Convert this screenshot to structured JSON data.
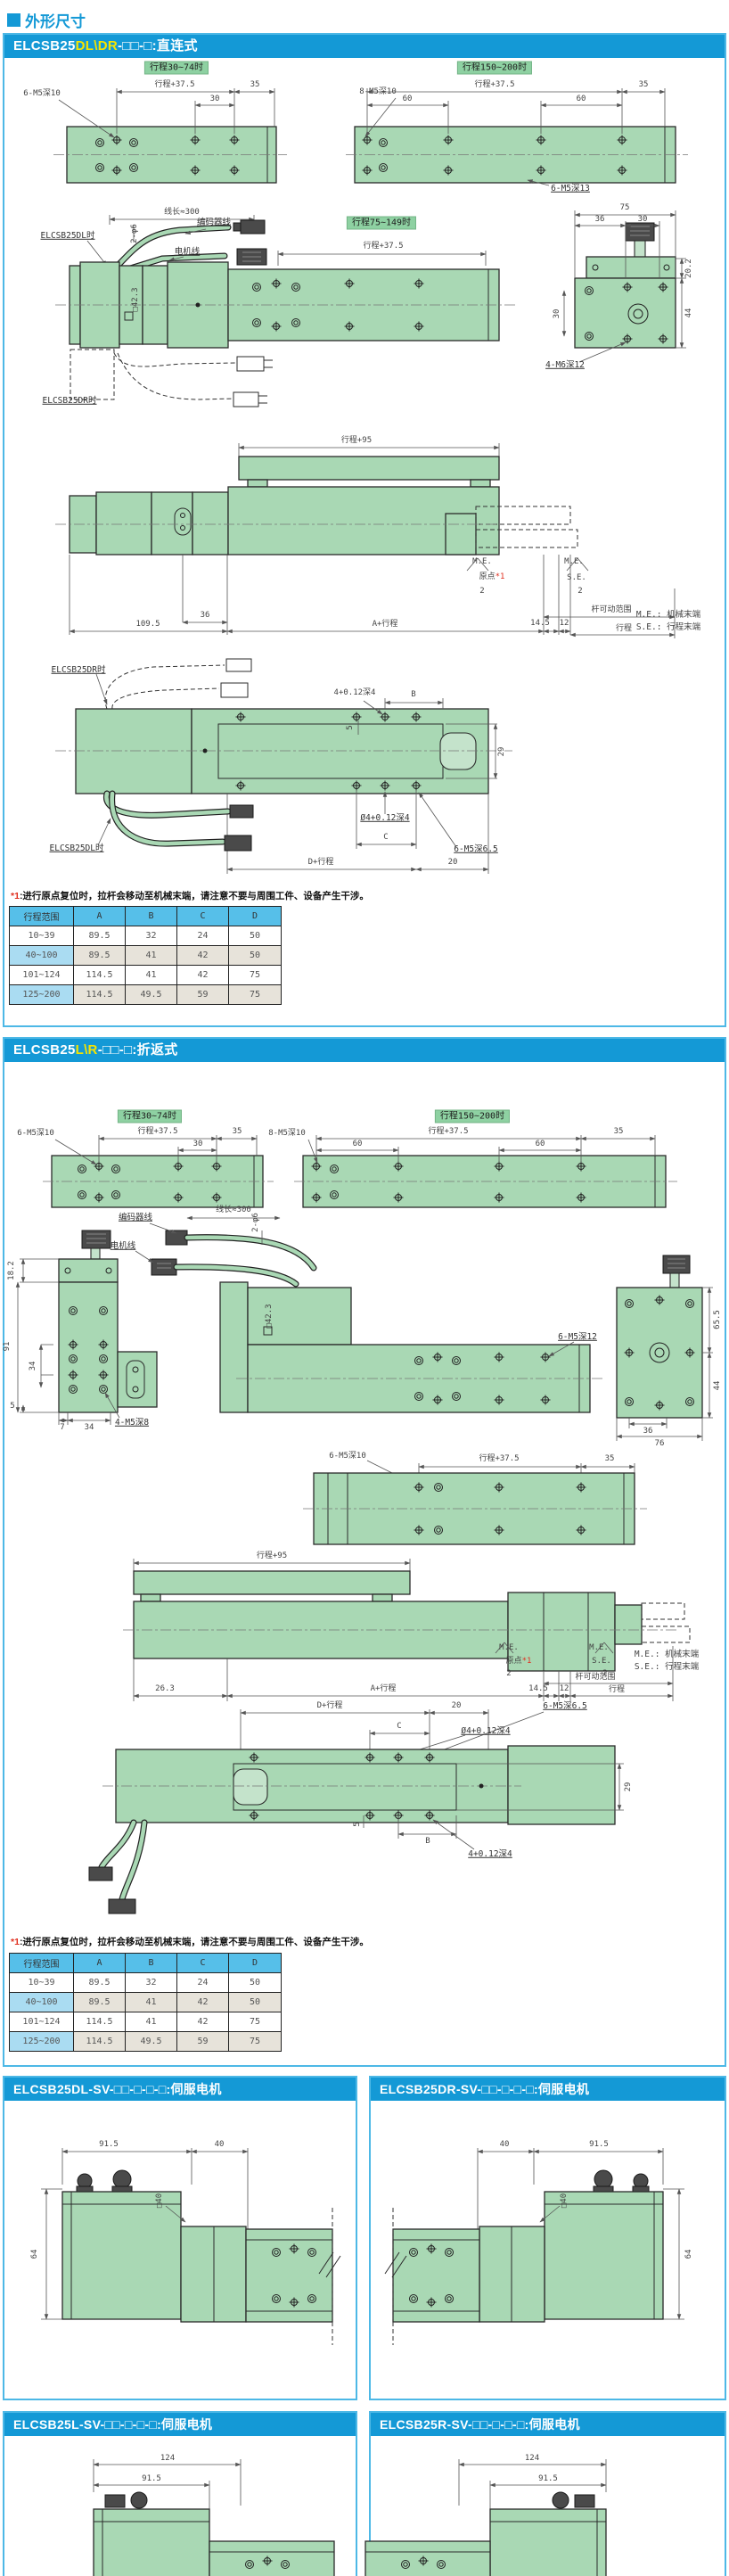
{
  "page": {
    "title": "外形尺寸"
  },
  "colors": {
    "blue": "#1499d6",
    "yellow": "#f6e400",
    "green_body": "#a9d8b4",
    "tag_green": "#8ed1a2",
    "table_header": "#56bfe9",
    "row_blue": "#aadcf2",
    "row_tan": "#e7e3da",
    "note_ref_red": "#e03020"
  },
  "panel_direct": {
    "header": {
      "prefix": "ELCSB25",
      "variant": "DL\\DR",
      "suffix": "-□□-□:直连式"
    },
    "top": {
      "tag_left": "行程30~74时",
      "tag_right": "行程150~200时",
      "stroke375_left": "行程+37.5",
      "d35_left": "35",
      "d30": "30",
      "leader_left": "6-M5深10",
      "stroke375_right": "行程+37.5",
      "d35_right": "35",
      "d60a": "60",
      "d60b": "60",
      "leader_right": "8-M5深10"
    },
    "cable": {
      "wire_len": "线长≈300",
      "phi6": "2-φ6",
      "encoder": "编码器线",
      "motor": "电机线",
      "dl": "ELCSB25DL时",
      "dr": "ELCSB25DR时"
    },
    "side": {
      "tag_mid": "行程75~149时",
      "stroke375": "行程+37.5",
      "sq423": "□42.3",
      "m5_13": "6-M5深13"
    },
    "end": {
      "d75": "75",
      "d36": "36",
      "d30": "30",
      "d20_2": "20.2",
      "d44": "44",
      "d30v": "30",
      "m6_12": "4-M6深12"
    },
    "stroke": {
      "s95": "行程+95",
      "me": "M.E.",
      "se": "S.E.",
      "origin": "原点",
      "ref": "*1",
      "d2": "2",
      "range": "杆可动范围",
      "stroke": "行程",
      "d109_5": "109.5",
      "d36": "36",
      "a_stroke": "A+行程",
      "d14_5": "14.5",
      "d12": "12",
      "legend_me": "M.E.: 机械末端",
      "legend_se": "S.E.: 行程末端"
    },
    "bottom": {
      "dr": "ELCSB25DR时",
      "dl": "ELCSB25DL时",
      "b": "B",
      "d4": "4+0.12深4",
      "d5": "5",
      "d29": "29",
      "phi4": "Ø4+0.12深4",
      "c": "C",
      "m5_65": "6-M5深6.5",
      "d_stroke": "D+行程",
      "d20": "20"
    },
    "note": {
      "ref": "*1",
      "text": ":进行原点复位时，拉杆会移动至机械末端，请注意不要与周围工件、设备产生干涉。"
    },
    "table": {
      "headers": [
        "行程范围",
        "A",
        "B",
        "C",
        "D"
      ],
      "rows": [
        [
          "10~39",
          "89.5",
          "32",
          "24",
          "50"
        ],
        [
          "40~100",
          "89.5",
          "41",
          "42",
          "50"
        ],
        [
          "101~124",
          "114.5",
          "41",
          "42",
          "75"
        ],
        [
          "125~200",
          "114.5",
          "49.5",
          "59",
          "75"
        ]
      ]
    }
  },
  "panel_return": {
    "header": {
      "prefix": "ELCSB25",
      "variant": "L\\R",
      "suffix": "-□□-□:折返式"
    },
    "top": {
      "tag_left": "行程30~74时",
      "tag_right": "行程150~200时",
      "stroke375_left": "行程+37.5",
      "d35_left": "35",
      "d30": "30",
      "leader_left": "6-M5深10",
      "stroke375_right": "行程+37.5",
      "d35_right": "35",
      "d60a": "60",
      "d60b": "60",
      "leader_right": "8-M5深10"
    },
    "cable": {
      "wire_len": "线长≈300",
      "phi6": "2-φ6",
      "encoder": "编码器线",
      "motor": "电机线"
    },
    "left_end": {
      "d18_2": "18.2",
      "d91": "91",
      "d34": "34",
      "d5": "5",
      "d7": "7",
      "d34b": "34",
      "m5_8": "4-M5深8"
    },
    "side": {
      "sq423": "□42.3",
      "m5_12": "6-M5深12"
    },
    "right_end": {
      "d65_5": "65.5",
      "d44": "44",
      "d36": "36",
      "d76": "76"
    },
    "plan": {
      "m5_10": "6-M5深10",
      "stroke375": "行程+37.5",
      "d35": "35"
    },
    "stroke": {
      "s95": "行程+95",
      "me": "M.E.",
      "se": "S.E.",
      "origin": "原点",
      "ref": "*1",
      "d2": "2",
      "range": "杆可动范围",
      "stroke": "行程",
      "d26_3": "26.3",
      "a_stroke": "A+行程",
      "d14_5": "14.5",
      "d12": "12",
      "legend_me": "M.E.: 机械末端",
      "legend_se": "S.E.: 行程末端"
    },
    "bottom": {
      "d_stroke": "D+行程",
      "d20": "20",
      "c": "C",
      "phi4": "Ø4+0.12深4",
      "m5_65": "6-M5深6.5",
      "b": "B",
      "d4": "4+0.12深4",
      "d5": "5",
      "d29": "29"
    },
    "note": {
      "ref": "*1",
      "text": ":进行原点复位时，拉杆会移动至机械末端，请注意不要与周围工件、设备产生干涉。"
    },
    "table": {
      "headers": [
        "行程范围",
        "A",
        "B",
        "C",
        "D"
      ],
      "rows": [
        [
          "10~39",
          "89.5",
          "32",
          "24",
          "50"
        ],
        [
          "40~100",
          "89.5",
          "41",
          "42",
          "50"
        ],
        [
          "101~124",
          "114.5",
          "41",
          "42",
          "75"
        ],
        [
          "125~200",
          "114.5",
          "49.5",
          "59",
          "75"
        ]
      ]
    }
  },
  "motor_panels": [
    {
      "header": "ELCSB25DL-SV-□□-□-□-□:伺服电机",
      "dim_a": "91.5",
      "dim_b": "40",
      "dim_square": "□40",
      "dim_h": "64"
    },
    {
      "header": "ELCSB25DR-SV-□□-□-□-□:伺服电机",
      "dim_a": "40",
      "dim_b": "91.5",
      "dim_square": "□40",
      "dim_h": "64"
    },
    {
      "header": "ELCSB25L-SV-□□-□-□-□:伺服电机",
      "dim_a": "124",
      "dim_b": "91.5"
    },
    {
      "header": "ELCSB25R-SV-□□-□-□-□:伺服电机",
      "dim_a": "124",
      "dim_b": "91.5"
    }
  ]
}
